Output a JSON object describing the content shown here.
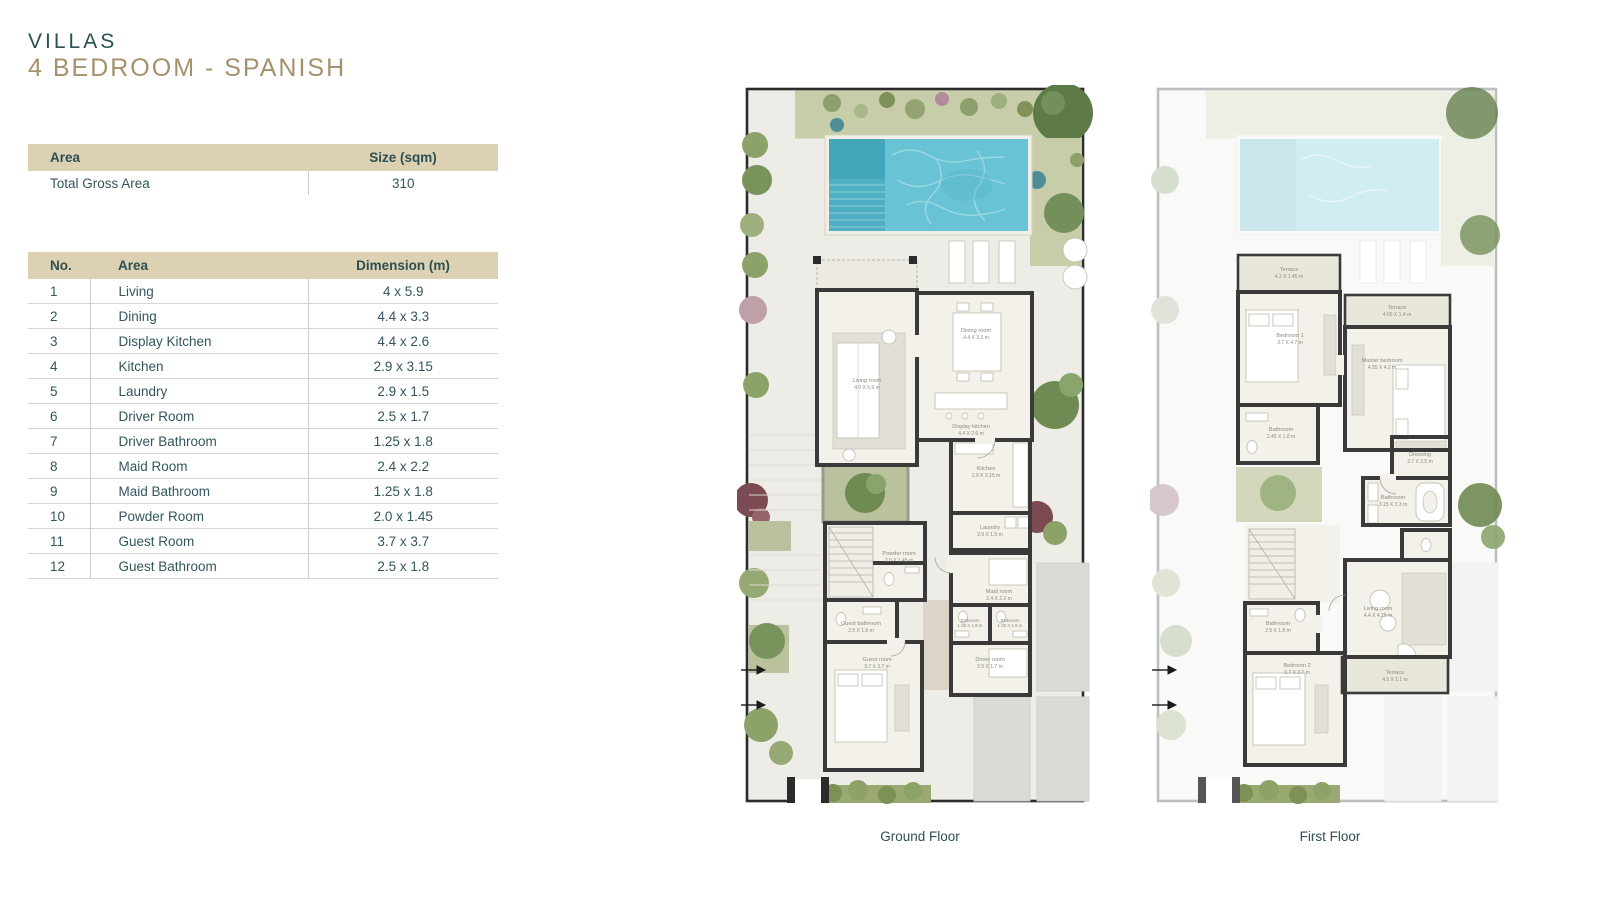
{
  "header": {
    "title": "VILLAS",
    "subtitle": "4 BEDROOM - SPANISH"
  },
  "area_table": {
    "col_area": "Area",
    "col_size": "Size (sqm)",
    "rows": [
      {
        "area": "Total Gross Area",
        "size": "310"
      }
    ]
  },
  "rooms_table": {
    "col_no": "No.",
    "col_area": "Area",
    "col_dim": "Dimension (m)",
    "rows": [
      {
        "no": "1",
        "area": "Living",
        "dim": "4 x 5.9"
      },
      {
        "no": "2",
        "area": "Dining",
        "dim": "4.4 x 3.3"
      },
      {
        "no": "3",
        "area": "Display Kitchen",
        "dim": "4.4 x 2.6"
      },
      {
        "no": "4",
        "area": "Kitchen",
        "dim": "2.9 x 3.15"
      },
      {
        "no": "5",
        "area": "Laundry",
        "dim": "2.9 x 1.5"
      },
      {
        "no": "6",
        "area": "Driver Room",
        "dim": "2.5 x 1.7"
      },
      {
        "no": "7",
        "area": "Driver Bathroom",
        "dim": "1.25 x 1.8"
      },
      {
        "no": "8",
        "area": "Maid Room",
        "dim": "2.4 x 2.2"
      },
      {
        "no": "9",
        "area": "Maid Bathroom",
        "dim": "1.25 x 1.8"
      },
      {
        "no": "10",
        "area": "Powder Room",
        "dim": "2.0 x 1.45"
      },
      {
        "no": "11",
        "area": "Guest Room",
        "dim": "3.7 x 3.7"
      },
      {
        "no": "12",
        "area": "Guest Bathroom",
        "dim": "2.5 x 1.8"
      }
    ]
  },
  "plans": {
    "ground": {
      "caption": "Ground Floor",
      "labels": {
        "living": {
          "name": "Living room",
          "dims": "4.0 X 5.9 m"
        },
        "dining": {
          "name": "Dining room",
          "dims": "4.4 X 3.3 m"
        },
        "display_kitchen": {
          "name": "Display kitchen",
          "dims": "4.4 X 2.6 m"
        },
        "kitchen": {
          "name": "Kitchen",
          "dims": "2.9 X 3.15 m"
        },
        "laundry": {
          "name": "Laundry",
          "dims": "2.9 X 1.5 m"
        },
        "maid": {
          "name": "Maid room",
          "dims": "2.4 X 2.2 m"
        },
        "bath1": {
          "name": "Bathroom",
          "dims": "1.25 X 1.8 m"
        },
        "bath2": {
          "name": "Bathroom",
          "dims": "1.25 X 1.8 m"
        },
        "driver": {
          "name": "Driver room",
          "dims": "2.5 X 1.7 m"
        },
        "powder": {
          "name": "Powder room",
          "dims": "2.0 X 1.45 m"
        },
        "guest_bath": {
          "name": "Guest bathroom",
          "dims": "2.5 X 1.8 m"
        },
        "guest": {
          "name": "Guest room",
          "dims": "3.7 X 3.7 m"
        }
      }
    },
    "first": {
      "caption": "First Floor",
      "labels": {
        "terrace1": {
          "name": "Terrace",
          "dims": "4.2 X 1.45 m"
        },
        "bedroom1": {
          "name": "Bedroom 1",
          "dims": "3.7 X 4.7 m"
        },
        "terrace2": {
          "name": "Terrace",
          "dims": "4.65 X 1.4 m"
        },
        "master": {
          "name": "Master bedroom",
          "dims": "4.55 X 4.2 m"
        },
        "bath1": {
          "name": "Bathroom",
          "dims": "2.45 X 1.8 m"
        },
        "dressing": {
          "name": "Dressing",
          "dims": "2.7 X 2.5 m"
        },
        "bath2": {
          "name": "Bathroom",
          "dims": "3.15 X 3.3 m"
        },
        "living": {
          "name": "Living room",
          "dims": "4.4 X 4.25 m"
        },
        "bath3": {
          "name": "Bathroom",
          "dims": "2.5 X 1.8 m"
        },
        "bedroom2": {
          "name": "Bedroom 2",
          "dims": "3.7 X 3.7 m"
        },
        "terrace3": {
          "name": "Terrace",
          "dims": "4.5 X 1.1 m"
        }
      }
    }
  },
  "colors": {
    "accent_teal": "#2d4f52",
    "accent_gold": "#a5916c",
    "table_header_bg": "#ddd1b4",
    "pool_water": "#68c4d4",
    "garden_green": "#c6cda8",
    "wall_dark": "#3a3a3a"
  }
}
